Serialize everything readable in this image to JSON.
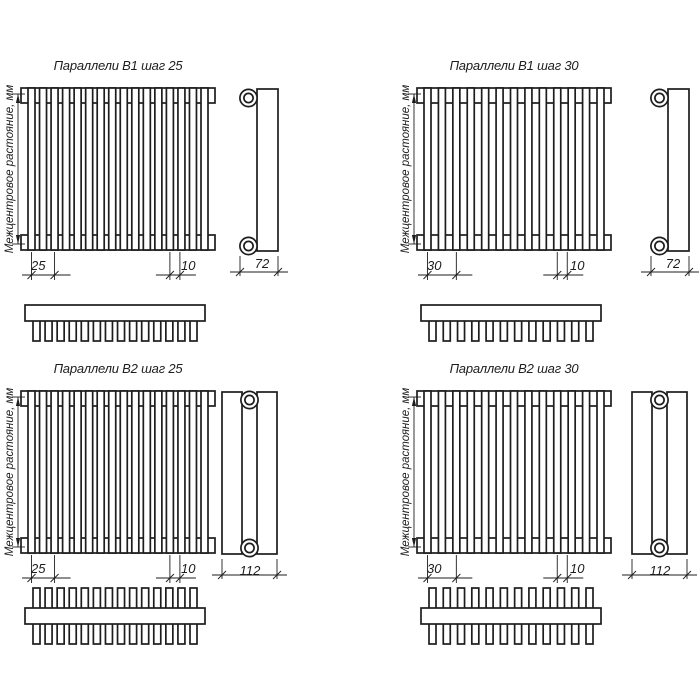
{
  "page": {
    "background": "#ffffff",
    "line_color": "#1d1d1d"
  },
  "axis_label": "Межцентровое растояние, мм",
  "panels": [
    {
      "title": "Параллели В1 шаг 25",
      "step_dim": "25",
      "tube_dim": "10",
      "depth_dim": "72",
      "front_tubes": 16,
      "top_teeth": 14,
      "rows": 1,
      "step": 25
    },
    {
      "title": "Параллели В1 шаг 30",
      "step_dim": "30",
      "tube_dim": "10",
      "depth_dim": "72",
      "front_tubes": 13,
      "top_teeth": 12,
      "rows": 1,
      "step": 30
    },
    {
      "title": "Параллели В2 шаг 25",
      "step_dim": "25",
      "tube_dim": "10",
      "depth_dim": "112",
      "front_tubes": 16,
      "top_teeth": 14,
      "rows": 2,
      "step": 25
    },
    {
      "title": "Параллели В2 шаг 30",
      "step_dim": "30",
      "tube_dim": "10",
      "depth_dim": "112",
      "front_tubes": 13,
      "top_teeth": 12,
      "rows": 2,
      "step": 30
    }
  ]
}
